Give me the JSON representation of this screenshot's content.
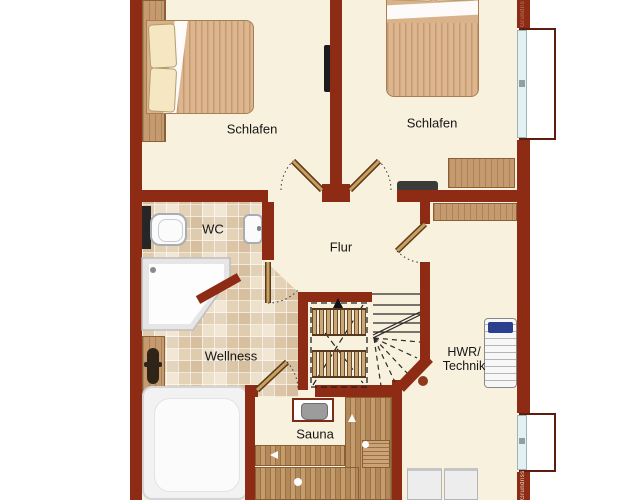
{
  "plan": {
    "type": "floor-plan",
    "rooms": {
      "bedroom_left": {
        "label": "Schlafen"
      },
      "bedroom_right": {
        "label": "Schlafen"
      },
      "wc": {
        "label": "WC"
      },
      "hall": {
        "label": "Flur"
      },
      "wellness": {
        "label": "Wellness"
      },
      "sauna": {
        "label": "Sauna"
      },
      "utility": {
        "label_line1": "HWR/",
        "label_line2": "Technik"
      }
    },
    "watermark": {
      "text": "Grundriss"
    },
    "colors": {
      "wall": "#8e2b15",
      "floor": "#f8f1dd",
      "tile": "#f1e7d4",
      "wood": "#c49a6e",
      "window_glass": "#e4f1f2",
      "appliance_blue": "#2b3f8e"
    }
  }
}
